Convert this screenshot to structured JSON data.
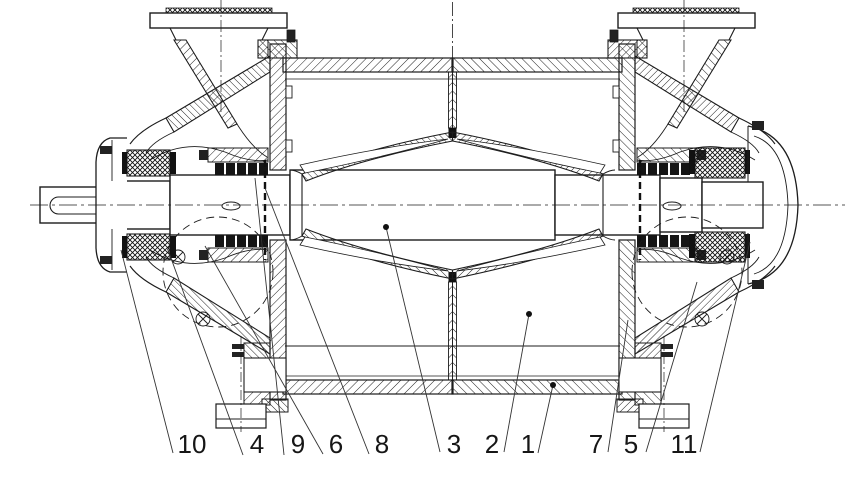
{
  "figure": {
    "kind": "technical sectional drawing",
    "subject": "pump longitudinal cross-section with numbered part callouts",
    "background_color": "#ffffff",
    "line_color": "#1c1c1c"
  },
  "part_labels": [
    "10",
    "4",
    "9",
    "6",
    "8",
    "3",
    "2",
    "1",
    "7",
    "5",
    "11"
  ]
}
